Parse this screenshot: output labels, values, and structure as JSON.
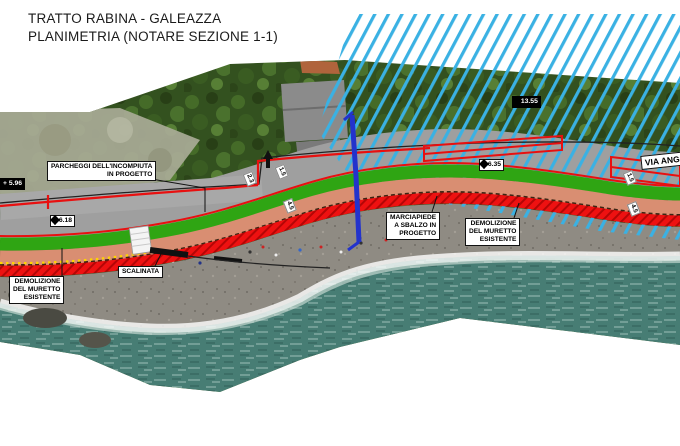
{
  "title": {
    "line1": "TRATTO RABINA - GALEAZZA",
    "line2": "PLANIMETRIA (NOTARE SEZIONE 1-1)"
  },
  "annotations": {
    "parcheggi": {
      "line1": "PARCHEGGI DELL'INCOMPIUTA",
      "line2": "IN PROGETTO"
    },
    "demolizione_left": {
      "line1": "DEMOLIZIONE",
      "line2": "DEL MURETTO",
      "line3": "ESISTENTE"
    },
    "scalinata": {
      "label": "SCALINATA"
    },
    "marciapiede": {
      "line1": "MARCIAPIEDE",
      "line2": "A SBALZO IN",
      "line3": "PROGETTO"
    },
    "demolizione_right": {
      "line1": "DEMOLIZIONE",
      "line2": "DEL MURETTO",
      "line3": "ESISTENTE"
    },
    "via_street": "VIA ANG"
  },
  "elevations": {
    "left_bar": "+ 5.96",
    "mid_left": "+ 6.18",
    "mid_right": "+ 6.35",
    "upper_right": "+ 13.55"
  },
  "dimensions": {
    "d1": "2.3",
    "d2": "1.5",
    "d3": "4.5",
    "d4": "1.5",
    "d5": "4.5"
  },
  "colors": {
    "c-red": "#e81010",
    "c-green": "#2fa513",
    "c-salmon": "#d98e72",
    "c-cyan": "#3ab1e3",
    "c-blue": "#2333cc",
    "c-yellow": "#ffd400"
  }
}
